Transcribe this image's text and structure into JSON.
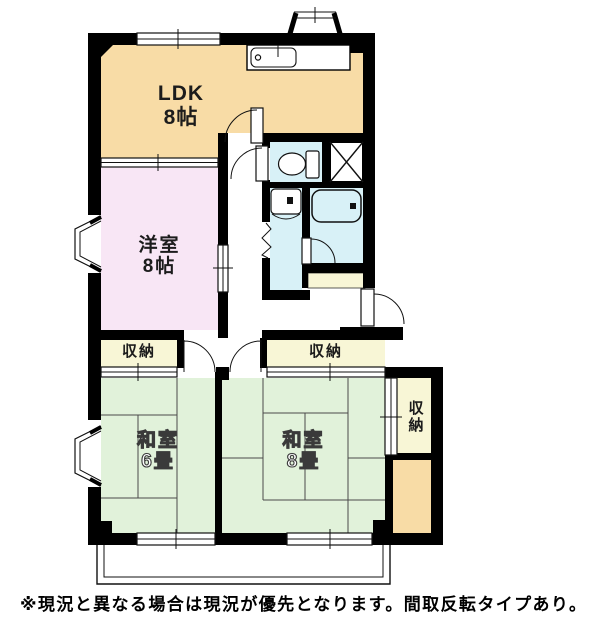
{
  "colors": {
    "ldk": "#f8dca6",
    "western": "#f8e6f5",
    "tatami": "#e1f2da",
    "storage": "#f8f6d6",
    "wet": "#d8f1f7",
    "wall": "#000000"
  },
  "rooms": {
    "ldk": {
      "name": "LDK",
      "size": "8帖"
    },
    "western_room": {
      "name": "洋室",
      "size": "8帖"
    },
    "tatami_room_6": {
      "name": "和室",
      "size": "6畳"
    },
    "tatami_room_8": {
      "name": "和室",
      "size": "8畳"
    },
    "closet_left": {
      "name": "収納"
    },
    "closet_right": {
      "name": "収納"
    },
    "closet_side": {
      "name": "収納"
    }
  },
  "icons": {
    "kitchen_sink": "kitchen-sink-icon",
    "toilet": "toilet-icon",
    "washbasin": "washbasin-icon",
    "bathtub": "bathtub-icon",
    "washing_machine_pan": "washing-machine-pan-x-icon"
  },
  "note": "※現況と異なる場合は現況が優先となります。間取反転タイプあり。"
}
